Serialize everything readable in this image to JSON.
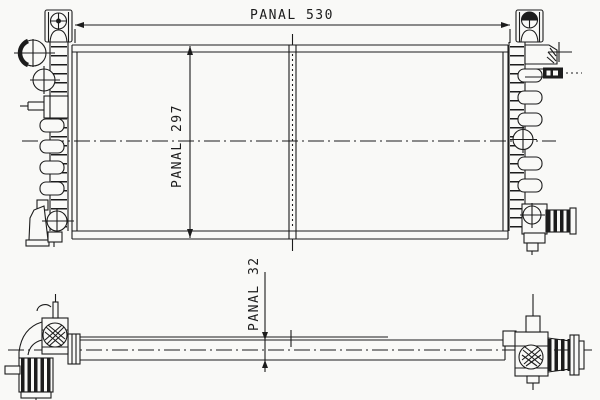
{
  "colors": {
    "background": "#f9f9f7",
    "ink": "#1c1c1c"
  },
  "drawing": {
    "dimensions": {
      "panel_width": {
        "label": "PANAL",
        "value": "530",
        "text": "PANAL 530"
      },
      "panel_height": {
        "label": "PANAL",
        "value": "297",
        "text": "PANAL 297"
      },
      "panel_depth": {
        "label": "PANAL",
        "value": "32",
        "text": "PANAL 32"
      }
    }
  }
}
